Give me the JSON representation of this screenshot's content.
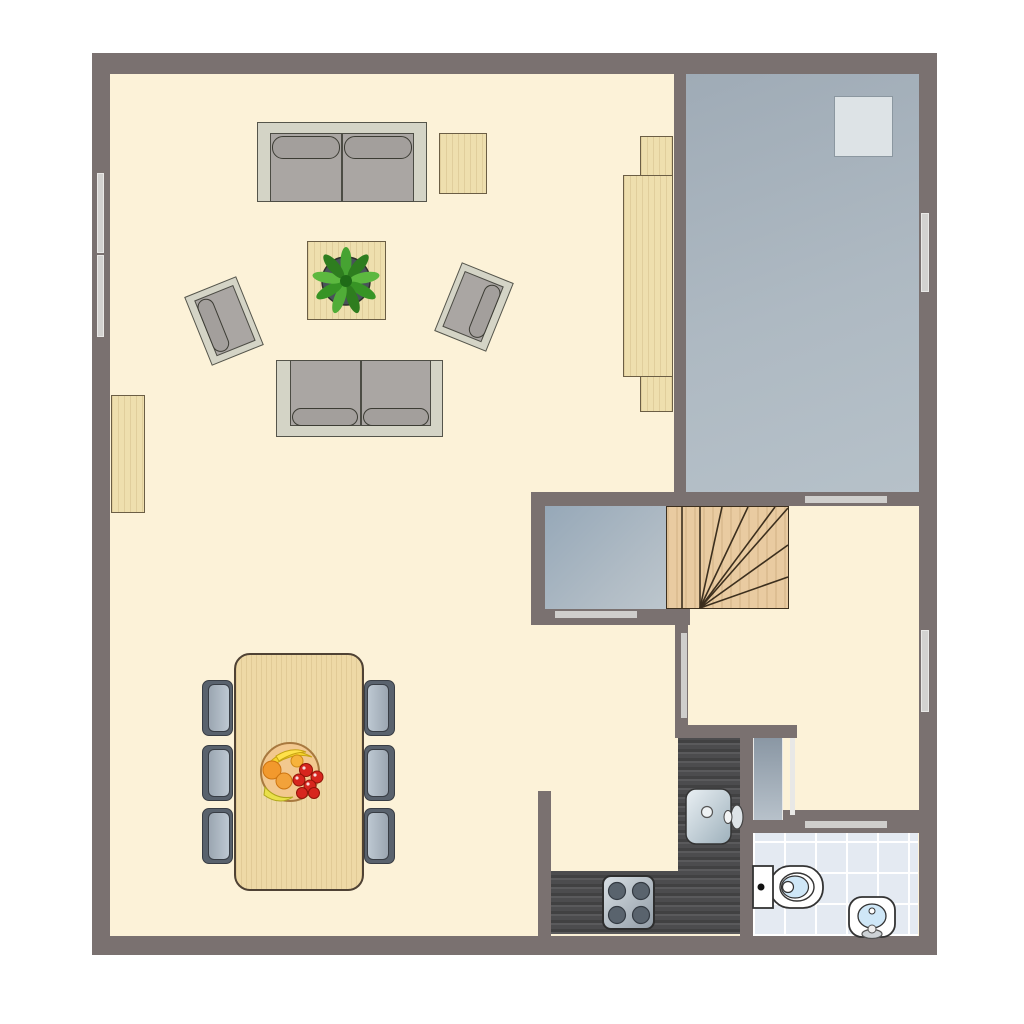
{
  "scene": {
    "type": "floor-plan",
    "label": "Apartment floor plan, top view",
    "canvas": "1024x1024",
    "background": "#ffffff"
  },
  "palette": {
    "wall": "#7a7170",
    "floor_cream": "#fcf2d8",
    "terrace_floor": "#a9b4bd",
    "entry_floor": "#a7b6c2",
    "wood_light": "#eedfae",
    "stairs_wood": "#e9cba1",
    "counter_dark": "#4c4c4e",
    "bath_tile": "#e4eaf2",
    "sofa_frame": "#d4d4c6",
    "sofa_cushion": "#aaa6a3",
    "chair_blue_gray": "#9aa5b1",
    "plant_green": "#3f9930",
    "fruit_red": "#d7261e",
    "outline": "#4c4c44"
  },
  "rooms": [
    {
      "id": "living-area",
      "label": "Living area with sofas and coffee table"
    },
    {
      "id": "dining-area",
      "label": "Dining area with table for six"
    },
    {
      "id": "kitchen",
      "label": "L-shaped kitchen corner"
    },
    {
      "id": "bathroom",
      "label": "Tiled bathroom"
    },
    {
      "id": "hallway",
      "label": "Hallway / landing"
    },
    {
      "id": "terrace-room",
      "label": "Gray-floored room top right"
    },
    {
      "id": "entry-nook",
      "label": "Gray-floored nook beside stairs"
    },
    {
      "id": "staircase",
      "label": "Winder staircase"
    }
  ],
  "furniture": [
    {
      "id": "sofa-top",
      "label": "Two-seat sofa facing down",
      "seats": 2
    },
    {
      "id": "sofa-bottom",
      "label": "Two-seat sofa facing up",
      "seats": 2
    },
    {
      "id": "armchair-left",
      "label": "Rotated armchair left"
    },
    {
      "id": "armchair-right",
      "label": "Rotated armchair right"
    },
    {
      "id": "coffee-table",
      "label": "Square coffee table with potted plant"
    },
    {
      "id": "side-table",
      "label": "Square wooden side table"
    },
    {
      "id": "sideboard-left",
      "label": "Wooden sideboard on left wall"
    },
    {
      "id": "cabinet-right",
      "label": "Tall wooden cabinet beside terrace room"
    },
    {
      "id": "dining-table",
      "label": "Wooden dining table with fruit bowl"
    },
    {
      "id": "dining-chairs",
      "label": "Blue-gray dining chairs",
      "count": 6
    }
  ],
  "fixtures": [
    {
      "id": "kitchen-sink",
      "label": "Kitchen sink with faucet"
    },
    {
      "id": "stove",
      "label": "Four-burner stove"
    },
    {
      "id": "toilet",
      "label": "Toilet with tank"
    },
    {
      "id": "bathroom-sink",
      "label": "Washbasin with faucet"
    },
    {
      "id": "skylight",
      "label": "Light square in terrace room"
    }
  ],
  "openings": {
    "windows": [
      {
        "id": "window-left",
        "label": "Double window, left wall"
      },
      {
        "id": "window-terrace",
        "label": "Window, terrace room right wall"
      },
      {
        "id": "window-hallway",
        "label": "Window, hallway right wall"
      }
    ],
    "doors": [
      {
        "id": "door-terrace",
        "label": "Opening to terrace room"
      },
      {
        "id": "door-entry-nook",
        "label": "Opening to entry nook"
      },
      {
        "id": "door-understairs",
        "label": "Doorway beside stairs"
      },
      {
        "id": "door-bathroom",
        "label": "Bathroom door opening"
      },
      {
        "id": "door-leaf",
        "label": "Open door leaf near bathroom"
      }
    ]
  }
}
